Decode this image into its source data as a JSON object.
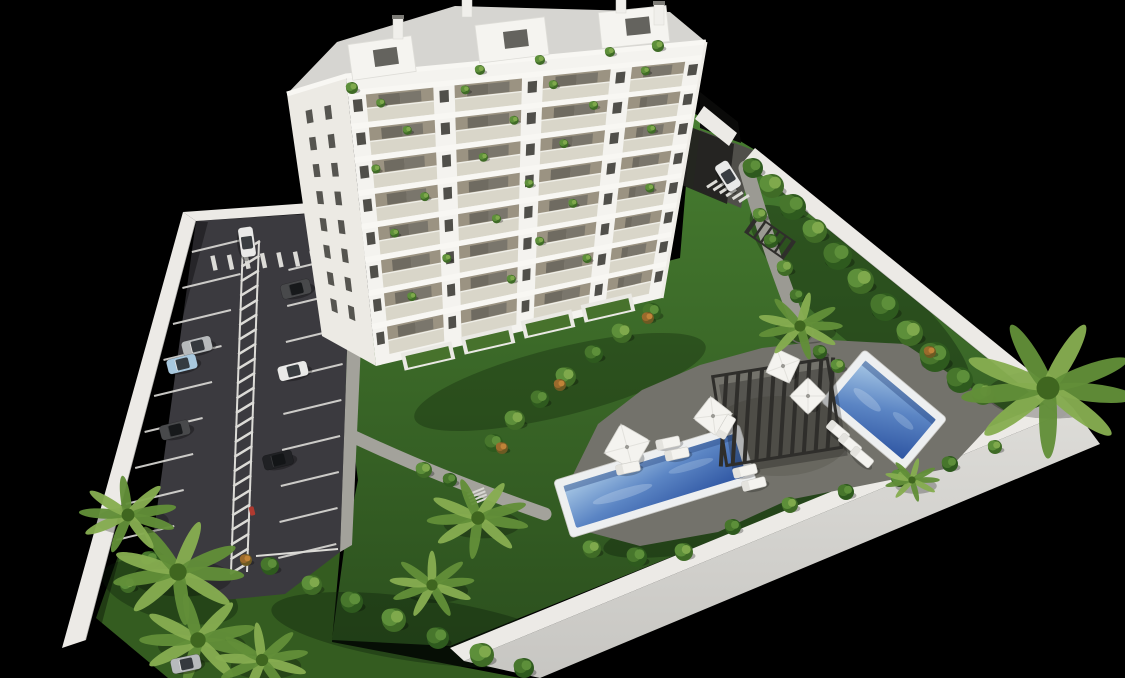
{
  "meta": {
    "title": "Aerial 3D architectural rendering of a white apartment tower with garden, two pools and parking lot on black background",
    "render_type": "3D visualization"
  },
  "palette": {
    "background": "#000000",
    "lawn_top": "#477d30",
    "lawn_bottom": "#2c501e",
    "lawnDark": "#345c20",
    "asphalt": "#3b3a3f",
    "marking": "#dcdbd7",
    "wall": "#eceae6",
    "wallFace": "#d7d6d2",
    "building": "#f4f3ef",
    "buildingShade": "#eceae4",
    "roofGravel": "#d6d5d1",
    "glass": "#d6d4c6",
    "balconyInterior": "#9b9382",
    "window": "#504f4a",
    "deck": "#73726b",
    "path": "#a3a29b",
    "poolRim": "#edeff0",
    "waterLight": "#a9c9e6",
    "waterMid": "#5b85c4",
    "waterDeep": "#2e55a2",
    "pergola": "#2f2e2b",
    "umbrella": "#f4f3ef",
    "lounger": "#f4f3ef",
    "carWhite": "#e9e9e8",
    "carSilver": "#b7babc",
    "carBlue": "#a8c8de",
    "carDark": "#48494b",
    "carBlack": "#202124",
    "scooterRed": "#b03a30"
  },
  "scene": {
    "building": {
      "floors": 8,
      "bays": [
        [
          0.05,
          0.24
        ],
        [
          0.3,
          0.49
        ],
        [
          0.55,
          0.74
        ],
        [
          0.8,
          0.95
        ]
      ],
      "pier_windows_u": [
        0.025,
        0.27,
        0.52,
        0.77,
        0.975
      ],
      "left_window_cols": [
        0.32,
        0.64
      ],
      "left_window_rows": 8,
      "balcony_plants": [
        [
          0.09,
          0.105
        ],
        [
          0.33,
          0.09
        ],
        [
          0.58,
          0.105
        ],
        [
          0.84,
          0.09
        ],
        [
          0.16,
          0.21
        ],
        [
          0.47,
          0.22
        ],
        [
          0.7,
          0.2
        ],
        [
          0.06,
          0.33
        ],
        [
          0.38,
          0.34
        ],
        [
          0.62,
          0.33
        ],
        [
          0.88,
          0.32
        ],
        [
          0.2,
          0.45
        ],
        [
          0.52,
          0.46
        ],
        [
          0.1,
          0.56
        ],
        [
          0.42,
          0.57
        ],
        [
          0.66,
          0.56
        ],
        [
          0.9,
          0.55
        ],
        [
          0.26,
          0.68
        ],
        [
          0.56,
          0.68
        ],
        [
          0.14,
          0.79
        ],
        [
          0.47,
          0.8
        ],
        [
          0.72,
          0.78
        ]
      ],
      "rooftop_plants": [
        [
          352,
          88,
          6
        ],
        [
          540,
          60,
          5
        ],
        [
          658,
          46,
          6
        ],
        [
          610,
          52,
          5
        ],
        [
          480,
          70,
          5
        ]
      ],
      "penthouses": [
        [
          382,
          58,
          -8,
          64,
          36
        ],
        [
          512,
          40,
          -7,
          70,
          38
        ],
        [
          634,
          27,
          -6,
          68,
          36
        ]
      ],
      "chimneys": [
        [
          398,
          28
        ],
        [
          467,
          6
        ],
        [
          621,
          2
        ],
        [
          659,
          14
        ]
      ],
      "terraces": [
        [
          428,
          356
        ],
        [
          488,
          340
        ],
        [
          548,
          324
        ],
        [
          608,
          308
        ]
      ]
    },
    "parking": {
      "left_spaces": 9,
      "right_spaces": 9,
      "hatch_dashes": 23,
      "crosswalk_dashes": 7,
      "entrance_crosswalk_dashes": 6,
      "scooter": [
        252,
        511
      ]
    },
    "cars": [
      {
        "x": 247,
        "y": 242,
        "a": 82,
        "c": "carWhite"
      },
      {
        "x": 296,
        "y": 289,
        "a": -14,
        "c": "carDark"
      },
      {
        "x": 197,
        "y": 346,
        "a": -14,
        "c": "carSilver"
      },
      {
        "x": 182,
        "y": 364,
        "a": -14,
        "c": "carBlue"
      },
      {
        "x": 293,
        "y": 371,
        "a": -14,
        "c": "carWhite"
      },
      {
        "x": 175,
        "y": 430,
        "a": -14,
        "c": "carDark"
      },
      {
        "x": 278,
        "y": 460,
        "a": -14,
        "c": "carBlack"
      },
      {
        "x": 186,
        "y": 664,
        "a": -12,
        "c": "carSilver"
      },
      {
        "x": 728,
        "y": 176,
        "a": 58,
        "c": "carWhite"
      }
    ],
    "pools": [
      {
        "name": "main-pool",
        "x": 655,
        "y": 481,
        "len": 194,
        "wid": 60,
        "angle": -17
      },
      {
        "name": "upper-pool",
        "x": 884,
        "y": 410,
        "len": 108,
        "wid": 68,
        "angle": 40
      }
    ],
    "pergola": {
      "x": 777,
      "y": 412,
      "w": 116,
      "h": 90,
      "angle": -9,
      "slats": 10
    },
    "mini_canopy": {
      "x": 770,
      "y": 237,
      "w": 46,
      "h": 20,
      "angle": 35,
      "slats": 6
    },
    "stairs": {
      "x": 478,
      "y": 497,
      "angle": -22,
      "steps": 4
    },
    "grass_island": {
      "x": 801,
      "y": 331,
      "r": 12
    },
    "umbrellas": [
      [
        627,
        447,
        17,
        30
      ],
      [
        713,
        416,
        14,
        38
      ],
      [
        783,
        366,
        13,
        25
      ],
      [
        808,
        396,
        13,
        45
      ]
    ],
    "loungers": [
      [
        668,
        443,
        -12
      ],
      [
        677,
        454,
        -12
      ],
      [
        628,
        468,
        -12
      ],
      [
        745,
        471,
        -14
      ],
      [
        754,
        484,
        -14
      ],
      [
        838,
        431,
        40
      ],
      [
        850,
        444,
        40
      ],
      [
        862,
        457,
        40
      ],
      [
        726,
        427,
        -60
      ]
    ],
    "bushes": [
      [
        753,
        168,
        10,
        0
      ],
      [
        772,
        186,
        12,
        1
      ],
      [
        793,
        207,
        13,
        0
      ],
      [
        815,
        231,
        12,
        1
      ],
      [
        838,
        256,
        14,
        0
      ],
      [
        861,
        281,
        13,
        1
      ],
      [
        885,
        307,
        14,
        0
      ],
      [
        910,
        333,
        13,
        1
      ],
      [
        935,
        357,
        15,
        0
      ],
      [
        960,
        380,
        13,
        0
      ],
      [
        983,
        394,
        11,
        1
      ],
      [
        760,
        215,
        7,
        1
      ],
      [
        771,
        241,
        7,
        0
      ],
      [
        785,
        268,
        8,
        1
      ],
      [
        797,
        296,
        7,
        0
      ],
      [
        652,
        312,
        9,
        0
      ],
      [
        622,
        333,
        10,
        1
      ],
      [
        594,
        354,
        9,
        0
      ],
      [
        566,
        377,
        10,
        1
      ],
      [
        540,
        399,
        9,
        0
      ],
      [
        515,
        420,
        10,
        1
      ],
      [
        494,
        443,
        9,
        0
      ],
      [
        648,
        318,
        6,
        2
      ],
      [
        560,
        385,
        6,
        2
      ],
      [
        502,
        448,
        6,
        2
      ],
      [
        930,
        352,
        6,
        2
      ],
      [
        246,
        560,
        6,
        2
      ],
      [
        592,
        549,
        9,
        1
      ],
      [
        637,
        557,
        10,
        0
      ],
      [
        684,
        552,
        9,
        1
      ],
      [
        733,
        527,
        8,
        0
      ],
      [
        790,
        505,
        8,
        1
      ],
      [
        846,
        492,
        8,
        0
      ],
      [
        900,
        478,
        9,
        1
      ],
      [
        950,
        464,
        8,
        0
      ],
      [
        995,
        447,
        7,
        1
      ],
      [
        838,
        366,
        7,
        1
      ],
      [
        820,
        352,
        7,
        0
      ],
      [
        312,
        585,
        10,
        1
      ],
      [
        352,
        602,
        11,
        0
      ],
      [
        394,
        620,
        12,
        1
      ],
      [
        438,
        638,
        11,
        0
      ],
      [
        482,
        655,
        12,
        1
      ],
      [
        524,
        668,
        10,
        0
      ],
      [
        270,
        566,
        9,
        0
      ],
      [
        150,
        560,
        9,
        0
      ],
      [
        128,
        585,
        8,
        1
      ],
      [
        424,
        470,
        8,
        1
      ],
      [
        450,
        480,
        7,
        0
      ]
    ],
    "palms": [
      [
        1048,
        388,
        82,
        10
      ],
      [
        800,
        326,
        40,
        0
      ],
      [
        478,
        518,
        48,
        15
      ],
      [
        432,
        585,
        40,
        -10
      ],
      [
        178,
        572,
        62,
        5
      ],
      [
        198,
        640,
        55,
        20
      ],
      [
        262,
        660,
        44,
        -15
      ],
      [
        128,
        515,
        46,
        25
      ],
      [
        912,
        480,
        26,
        0
      ]
    ]
  }
}
